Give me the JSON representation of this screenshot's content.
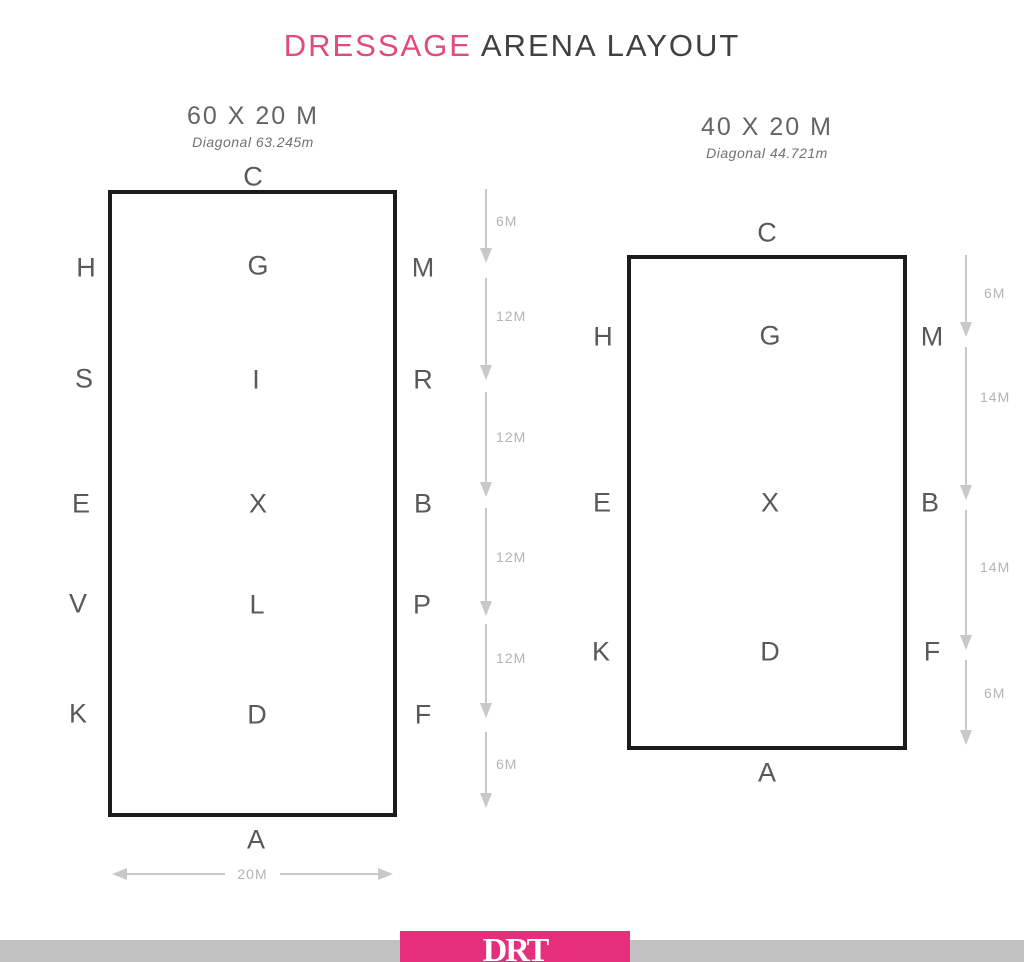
{
  "title": {
    "accent": "DRESSAGE",
    "rest": "ARENA LAYOUT"
  },
  "arenas": [
    {
      "id": "arena-60x20",
      "size_label": "60 X 20 M",
      "diagonal_label": "Diagonal 63.245m",
      "width_label": "20M",
      "letters": {
        "top": "C",
        "bottom": "A",
        "left": [
          "H",
          "S",
          "E",
          "V",
          "K"
        ],
        "right": [
          "M",
          "R",
          "B",
          "P",
          "F"
        ],
        "center": [
          "G",
          "I",
          "X",
          "L",
          "D"
        ]
      },
      "measurements": [
        "6M",
        "12M",
        "12M",
        "12M",
        "12M",
        "6M"
      ]
    },
    {
      "id": "arena-40x20",
      "size_label": "40 X 20 M",
      "diagonal_label": "Diagonal 44.721m",
      "letters": {
        "top": "C",
        "bottom": "A",
        "left": [
          "H",
          "E",
          "K"
        ],
        "right": [
          "M",
          "B",
          "F"
        ],
        "center": [
          "G",
          "X",
          "D"
        ]
      },
      "measurements": [
        "6M",
        "14M",
        "14M",
        "6M"
      ]
    }
  ],
  "footer": {
    "logo_text": "DRT"
  },
  "colors": {
    "title_accent_pink": "#e2497f",
    "title_dark_gray": "#3f4042",
    "letter_gray": "#58595b",
    "arrow_gray": "#c8c8c9",
    "measure_label_gray": "#b4b4b6",
    "arena_border_black": "#1b1b1b",
    "footer_pink": "#e72e7c",
    "footer_bar_gray": "#c2c2c3"
  }
}
